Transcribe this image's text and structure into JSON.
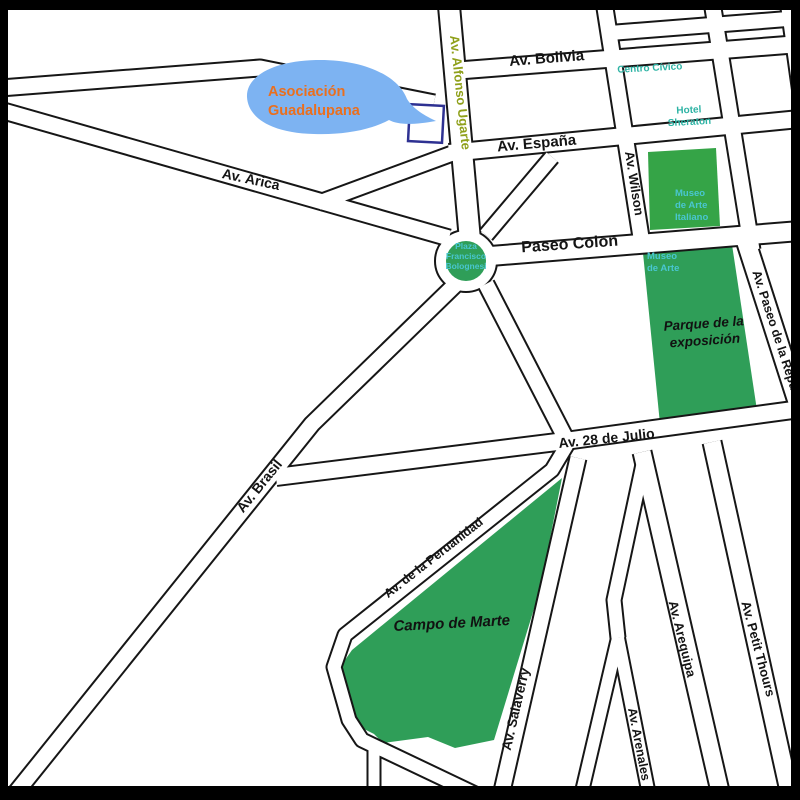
{
  "map": {
    "region": "Lima city centre street map",
    "colors": {
      "park_green": "#2f9e58",
      "museo_block_green": "#35a447",
      "road_outline": "#161616",
      "road_fill": "#ffffff",
      "frame": "#000000",
      "bubble_blue": "#7db3f2",
      "callout_orange": "#ea6f1e",
      "poi_teal": "#2db3a4",
      "poi_teal_on_green": "#49c6d0",
      "street_olive": "#8fa01a",
      "highlight_navy": "#2e3192"
    },
    "callout": {
      "lines": [
        "Asociación",
        "Guadalupana"
      ]
    },
    "labels": [
      {
        "id": "av-bolivia",
        "text": "Av. Bolivia",
        "x": 547,
        "y": 63,
        "r": -4.5,
        "s": 15,
        "c": "street"
      },
      {
        "id": "av-espana",
        "text": "Av. España",
        "x": 537,
        "y": 148,
        "r": -5,
        "s": 15,
        "c": "street"
      },
      {
        "id": "paseo-colon",
        "text": "Paseo Colon",
        "x": 570,
        "y": 249,
        "r": -4,
        "s": 16,
        "c": "street"
      },
      {
        "id": "av-28-de-julio",
        "text": "Av. 28 de Julio",
        "x": 607,
        "y": 443,
        "r": -6,
        "s": 14,
        "c": "street"
      },
      {
        "id": "av-alfonso-ugarte",
        "text": "Av. Alfonso Ugarte",
        "x": 456,
        "y": 93,
        "r": 84,
        "s": 13,
        "c": "street-olive",
        "fill": "#8fa01a"
      },
      {
        "id": "av-wilson",
        "text": "Av. Wilson",
        "x": 630,
        "y": 184,
        "r": 81,
        "s": 13,
        "c": "street"
      },
      {
        "id": "av-paseo-republica",
        "text": "Av. Paseo de la República",
        "x": 776,
        "y": 345,
        "r": 72,
        "s": 12.5,
        "c": "street"
      },
      {
        "id": "av-arica",
        "text": "Av. Arica",
        "x": 250,
        "y": 184,
        "r": 12,
        "s": 14,
        "c": "street"
      },
      {
        "id": "av-brasil",
        "text": "Av. Brasil",
        "x": 263,
        "y": 489,
        "r": -51,
        "s": 14,
        "c": "street"
      },
      {
        "id": "av-peruanidad",
        "text": "Av. de la Peruanidad",
        "x": 436,
        "y": 561,
        "r": -38,
        "s": 12.5,
        "c": "street"
      },
      {
        "id": "av-salaverry",
        "text": "Av. Salaverry",
        "x": 520,
        "y": 710,
        "r": -77,
        "s": 13.5,
        "c": "street"
      },
      {
        "id": "av-arenales",
        "text": "Av. Arenales",
        "x": 635,
        "y": 745,
        "r": 79,
        "s": 12.5,
        "c": "street"
      },
      {
        "id": "av-arequipa",
        "text": "Av. Arequipa",
        "x": 678,
        "y": 640,
        "r": 76,
        "s": 13,
        "c": "street"
      },
      {
        "id": "av-petit-thours",
        "text": "Av. Petit Thours",
        "x": 754,
        "y": 650,
        "r": 75,
        "s": 13,
        "c": "street"
      },
      {
        "id": "campo-de-marte",
        "text": "Campo de Marte",
        "x": 452,
        "y": 628,
        "r": -3,
        "s": 15,
        "c": "park-name"
      },
      {
        "id": "parque-exposicion",
        "lines": [
          "Parque de la",
          "exposición"
        ],
        "x": 704,
        "y": 328,
        "lh": 17,
        "r": -4,
        "s": 13.5,
        "c": "park-name"
      },
      {
        "id": "centro-civico",
        "text": "Centro Cívico",
        "x": 650,
        "y": 71,
        "r": -3,
        "s": 10,
        "c": "poi-teal",
        "fill": "#2db3a4"
      },
      {
        "id": "hotel-sheraton",
        "lines": [
          "Hotel",
          "Sheraton"
        ],
        "x": 689,
        "y": 113,
        "lh": 12,
        "r": -3,
        "s": 10,
        "c": "poi-teal",
        "fill": "#2db3a4"
      },
      {
        "id": "museo-arte-italiano",
        "lines": [
          "Museo",
          "de Arte",
          "Italiano"
        ],
        "x": 675,
        "y": 196,
        "lh": 12,
        "s": 9.5,
        "c": "poi-light",
        "anchor": "start",
        "fill": "#49c6d0"
      },
      {
        "id": "museo-de-arte",
        "lines": [
          "Museo",
          "de Arte"
        ],
        "x": 647,
        "y": 259,
        "lh": 12,
        "s": 9.5,
        "c": "poi-light",
        "anchor": "start",
        "fill": "#49c6d0"
      },
      {
        "id": "plaza-bolognesi",
        "lines": [
          "Plaza",
          "Francisco",
          "Bolognesi"
        ],
        "x": 466,
        "y": 249,
        "lh": 10,
        "s": 8.5,
        "c": "poi-light",
        "fill": "#49c6d0"
      },
      {
        "id": "asociacion-guadalupana",
        "lines": [
          "Asociación",
          "Guadalupana"
        ],
        "x": 268,
        "y": 96,
        "lh": 19,
        "s": 14.5,
        "c": "bubble-text",
        "anchor": "start",
        "fill": "#ea6f1e"
      }
    ]
  }
}
